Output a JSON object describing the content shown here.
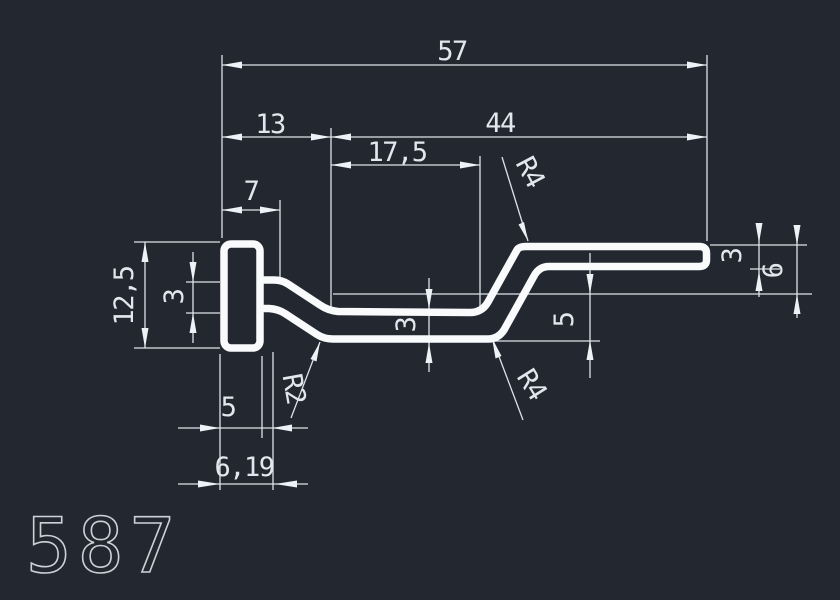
{
  "app": {
    "type": "cad-drawing-viewport",
    "description": "profile cross-section technical drawing"
  },
  "part_number": "587",
  "colors": {
    "background": "#232830",
    "profile_stroke": "#f8fafc",
    "dimension_lines": "#dde1e8",
    "dimension_text": "#e3e7ed",
    "part_number_text": "#ccd1d8"
  },
  "dimensions": {
    "overall_width": "57",
    "upper_left": "13",
    "upper_right": "44",
    "middle_span": "17,5",
    "head_ledge": "7",
    "head_height": "12,5",
    "arm_thickness": "3",
    "middle_thickness": "3",
    "step_height": "5",
    "end_thickness": "3",
    "end_offset": "6",
    "head_width": "5",
    "foot_width": "6,19"
  },
  "radii": {
    "top": "R4",
    "bottom": "R4",
    "small": "R2"
  }
}
